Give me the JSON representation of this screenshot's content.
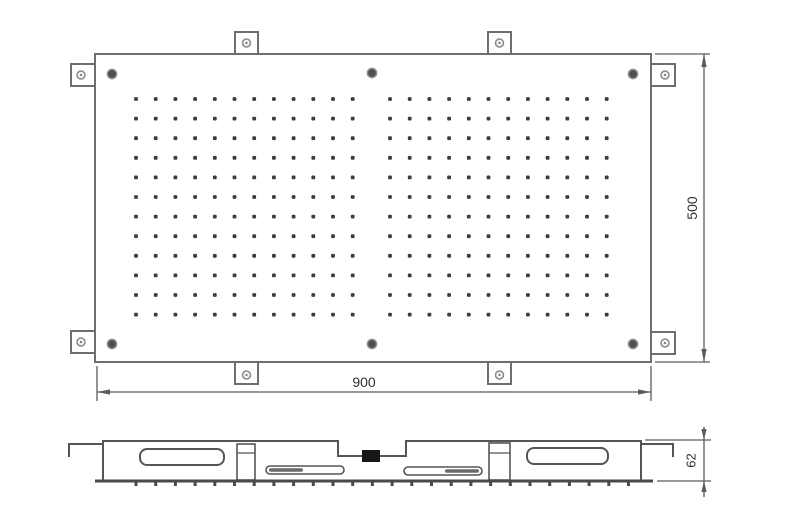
{
  "drawing": {
    "colors": {
      "background": "#ffffff",
      "line": "#6e6e6e",
      "side_line": "#555555",
      "dim_line": "#5a5a5a",
      "text": "#2f2f2f",
      "dot": "#3c3c3c",
      "screw_fill": "#4f4f4f",
      "screw_ring": "#909090",
      "tab_hole_fill": "#f2f2f2",
      "tab_hole_ring": "#8a8a8a",
      "inlet": "#161616",
      "bottom_edge": "#4a4a4a"
    },
    "dimensions": {
      "width": "900",
      "height": "500",
      "thickness": "62"
    },
    "top_view": {
      "panel": {
        "x": 95,
        "y": 54,
        "w": 556,
        "h": 308
      },
      "nozzle_grid": {
        "rows": 12,
        "cols": 12,
        "row_start_y": 99,
        "row_spacing": 19.6,
        "col_spacing": 19.7,
        "dot_size": 3.8,
        "groups": [
          {
            "start_x": 136
          },
          {
            "start_x": 390
          }
        ]
      },
      "screws": [
        [
          112,
          74
        ],
        [
          372,
          73
        ],
        [
          633,
          74
        ],
        [
          112,
          344
        ],
        [
          372,
          344
        ],
        [
          633,
          344
        ]
      ],
      "tabs": [
        {
          "x": 235,
          "y": 32,
          "w": 23,
          "h": 22,
          "cx": 246.5,
          "cy": 43,
          "side": "top"
        },
        {
          "x": 488,
          "y": 32,
          "w": 23,
          "h": 22,
          "cx": 499.5,
          "cy": 43,
          "side": "top"
        },
        {
          "x": 235,
          "y": 362,
          "w": 23,
          "h": 22,
          "cx": 246.5,
          "cy": 375,
          "side": "bottom"
        },
        {
          "x": 488,
          "y": 362,
          "w": 23,
          "h": 22,
          "cx": 499.5,
          "cy": 375,
          "side": "bottom"
        },
        {
          "x": 71,
          "y": 64,
          "w": 24,
          "h": 22,
          "cx": 81,
          "cy": 75,
          "side": "left"
        },
        {
          "x": 71,
          "y": 331,
          "w": 24,
          "h": 22,
          "cx": 81,
          "cy": 342,
          "side": "left"
        },
        {
          "x": 651,
          "y": 64,
          "w": 24,
          "h": 22,
          "cx": 665,
          "cy": 75,
          "side": "right"
        },
        {
          "x": 651,
          "y": 332,
          "w": 24,
          "h": 22,
          "cx": 665,
          "cy": 343,
          "side": "right"
        }
      ]
    },
    "side_view": {
      "nozzle_ticks": {
        "start_x": 136,
        "spacing": 19.7,
        "count": 26,
        "y": 481.5,
        "length": 4.5
      }
    }
  }
}
